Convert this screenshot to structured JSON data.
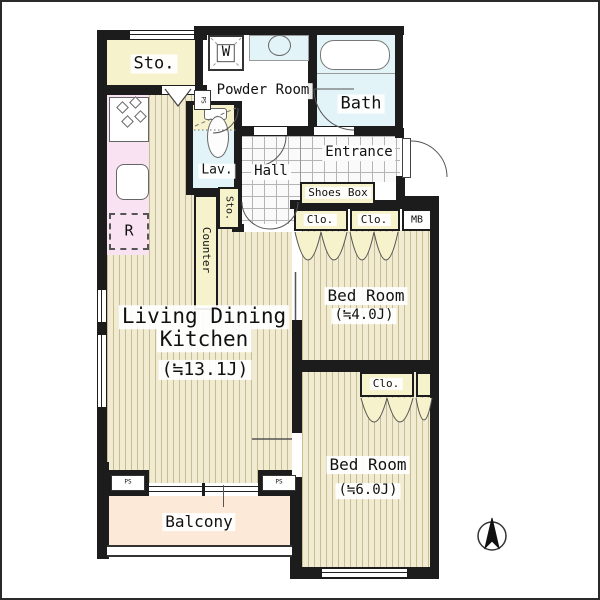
{
  "title": "apartment-floor-plan",
  "rooms": {
    "sto_top": "Sto.",
    "powder_room": "Powder Room",
    "bath": "Bath",
    "washer": "W",
    "entrance": "Entrance",
    "hall": "Hall",
    "lavatory": "Lav.",
    "shoes_box": "Shoes Box",
    "closet_1": "Clo.",
    "closet_2": "Clo.",
    "closet_3": "Clo.",
    "meter_box": "MB",
    "pipe_space_top": "PS",
    "pipe_space_left": "PS",
    "pipe_space_right": "PS",
    "counter": "Counter",
    "sto_small": "Sto.",
    "refrigerator": "R",
    "ldk_name_line1": "Living Dining",
    "ldk_name_line2": "Kitchen",
    "ldk_size": "(≒13.1J)",
    "bedroom1_name": "Bed Room",
    "bedroom1_size": "(≒4.0J)",
    "bedroom2_name": "Bed Room",
    "bedroom2_size": "(≒6.0J)",
    "balcony": "Balcony"
  },
  "colors": {
    "wall": "#1c1c1c",
    "wood_floor_base": "#f1ebd1",
    "wood_floor_stripe": "#c8bc92",
    "closet_cream": "#f6f2cb",
    "kitchen_pink": "#f9e3f2",
    "bath_cyan": "#e2f4f8",
    "balcony_peach": "#fce9d8",
    "tile_line": "#b5b5b5"
  }
}
